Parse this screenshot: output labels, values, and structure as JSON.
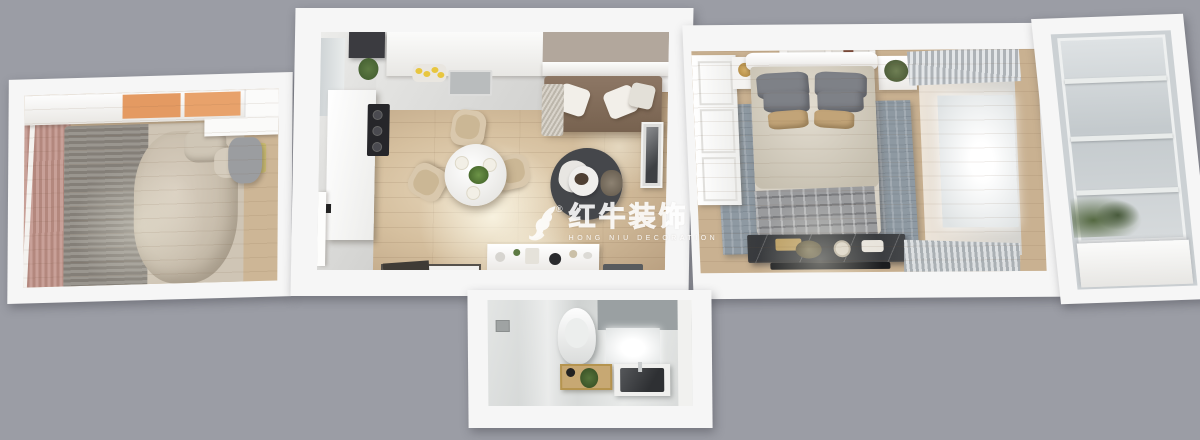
{
  "scene": {
    "description": "top-down 3d dollhouse render of a small apartment floor plan",
    "background_color": "#9b9da5"
  },
  "watermark": {
    "logo": "bull-icon",
    "registered": "®",
    "brand": "红牛装饰",
    "subtitle": "HONG NIU DECORATION",
    "color": "#ffffff"
  },
  "palette": {
    "wall_white": "#f6f6f6",
    "wood_living": "#d5bf9e",
    "wood_bedroom": "#c9b191",
    "kitchen_tile": "#e4e4e2",
    "bathroom_tile": "#d9dbda",
    "cabinet_orange": "#e49a62",
    "curtain_pink": "#c89f98",
    "sofa_brown": "#8d7765",
    "round_rug_dark": "#45474b",
    "bedroom_rug_blue": "#8e99a2",
    "marble_dresser_dark": "#3a3c3f",
    "plaid_throw_gray": "#9a9b9d",
    "plant_green": "#5d7a43",
    "lemon_yellow": "#e8c63f"
  }
}
